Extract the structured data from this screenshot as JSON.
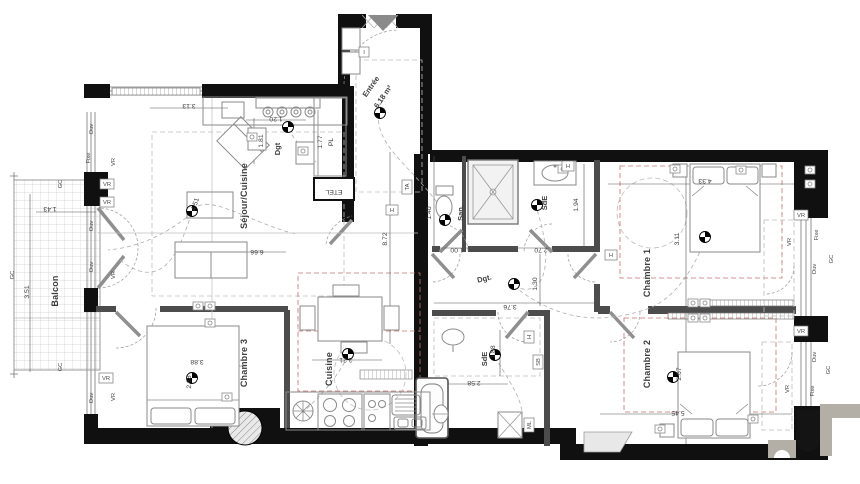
{
  "rooms": [
    {
      "text": "Séjour/Cuisine"
    },
    {
      "text": "Entrée"
    },
    {
      "text": "6.18 m²"
    },
    {
      "text": "Balcon"
    },
    {
      "text": "Chambre 3"
    },
    {
      "text": "Cuisine"
    },
    {
      "text": "San."
    },
    {
      "text": "SdE"
    },
    {
      "text": "SdE"
    },
    {
      "text": "Chambre 1"
    },
    {
      "text": "Chambre 2"
    },
    {
      "text": "Dgt"
    },
    {
      "text": "Dgt."
    }
  ],
  "dimensions": [
    {
      "text": "3.13"
    },
    {
      "text": "1.20"
    },
    {
      "text": "1.81"
    },
    {
      "text": "1.77"
    },
    {
      "text": "PL"
    },
    {
      "text": "ETEL"
    },
    {
      "text": "6.66"
    },
    {
      "text": "4.51"
    },
    {
      "text": "3.51"
    },
    {
      "text": "1.43"
    },
    {
      "text": "8.72"
    },
    {
      "text": "1.40"
    },
    {
      "text": "1.00"
    },
    {
      "text": "2.70"
    },
    {
      "text": "1.94"
    },
    {
      "text": "1.30"
    },
    {
      "text": "3.76"
    },
    {
      "text": "2.58"
    },
    {
      "text": "1.88"
    },
    {
      "text": "3.88"
    },
    {
      "text": "2.68"
    },
    {
      "text": "2.21"
    },
    {
      "text": "4.33"
    },
    {
      "text": "3.11"
    },
    {
      "text": "5.45"
    },
    {
      "text": "2.67"
    }
  ],
  "tags": [
    {
      "text": "Ouv"
    },
    {
      "text": "Fixe"
    },
    {
      "text": "Ouv"
    },
    {
      "text": "Ouv"
    },
    {
      "text": "Ouv"
    },
    {
      "text": "VR"
    },
    {
      "text": "VR"
    },
    {
      "text": "VR"
    },
    {
      "text": "VR"
    },
    {
      "text": "VR"
    },
    {
      "text": "VR"
    },
    {
      "text": "GC"
    },
    {
      "text": "GC"
    },
    {
      "text": "GC"
    },
    {
      "text": "Fixe"
    },
    {
      "text": "Ouv"
    },
    {
      "text": "GC"
    },
    {
      "text": "VR"
    },
    {
      "text": "VR"
    },
    {
      "text": "Ouv"
    },
    {
      "text": "Fixe"
    },
    {
      "text": "GC"
    },
    {
      "text": "VR"
    },
    {
      "text": "VR"
    },
    {
      "text": "TA"
    },
    {
      "text": "H"
    },
    {
      "text": "H"
    },
    {
      "text": "H"
    },
    {
      "text": "H"
    },
    {
      "text": "ML"
    },
    {
      "text": "SB"
    },
    {
      "text": "I"
    }
  ],
  "colors": {
    "wall": "#101010",
    "partition": "#4c4c4c",
    "red_dash": "#c4736a",
    "watermark_gray": "#b3aea6"
  }
}
